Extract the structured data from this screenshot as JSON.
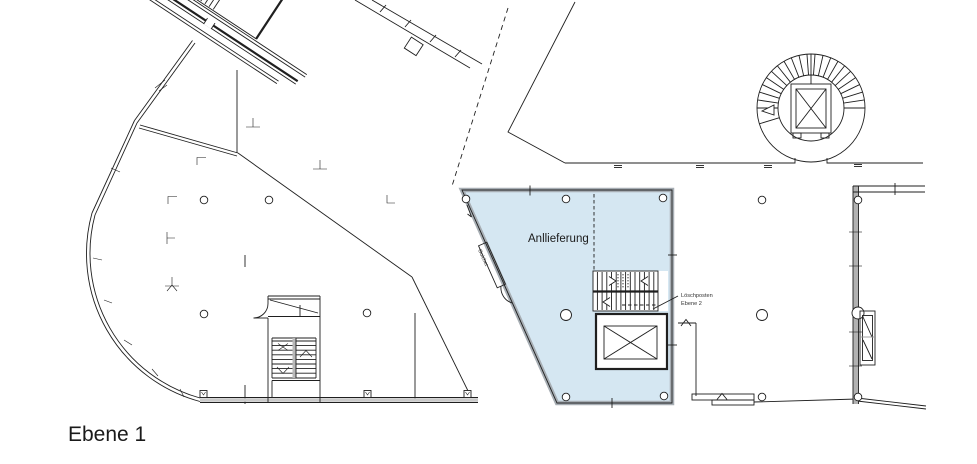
{
  "colors": {
    "background": "#ffffff",
    "line": "#1f1f1f",
    "zone_fill": "#d5e7f2",
    "zone_border": "#a7aeb4",
    "wall_gray": "#b2b2b2"
  },
  "plan": {
    "level_label": "Ebene 1",
    "delivery_zone_label": "Anllieferung",
    "counter_label": "Guichet",
    "fire_post_label_line1": "Löschposten",
    "fire_post_label_line2": "Ebene 2"
  }
}
